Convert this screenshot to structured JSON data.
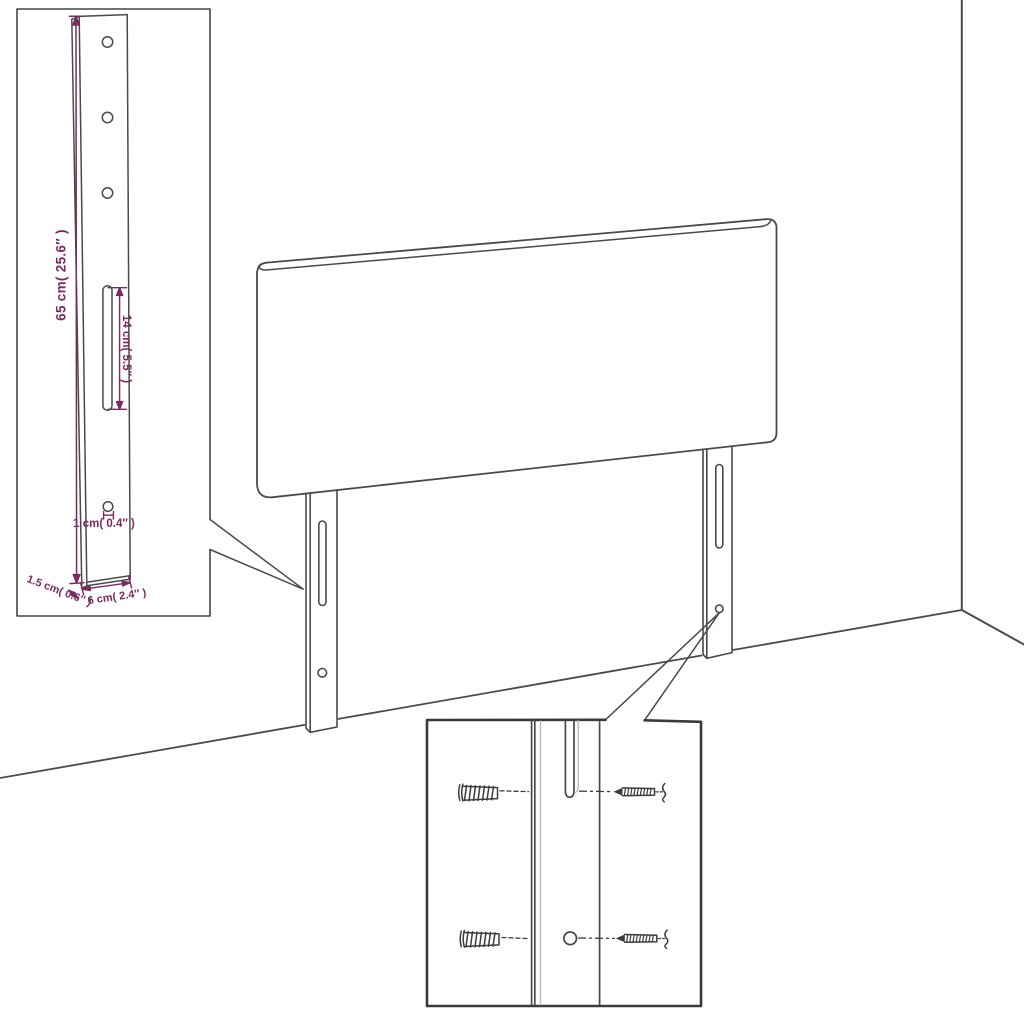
{
  "canvas": {
    "width": 1024,
    "height": 1024,
    "background": "#ffffff"
  },
  "palette": {
    "line_art": "#4a4a4a",
    "detail_box_line": "#3a3a3a",
    "light_line": "#b5b5b5",
    "dimension": "#7b2a61"
  },
  "diagram": {
    "kind": "furniture-dimension-line-drawing",
    "subject": "upholstered headboard with two slotted mounting legs, wall corner, and two zoom callouts"
  },
  "annotations": {
    "bracket_height": "65 cm( 25.6″ )",
    "slot_length": "14 cm( 5.5″ )",
    "hole_diameter": "1 cm( 0.4″ )",
    "bracket_thickness": "1.5 cm( 0.6″ )",
    "bracket_width": "6 cm( 2.4″ )"
  }
}
